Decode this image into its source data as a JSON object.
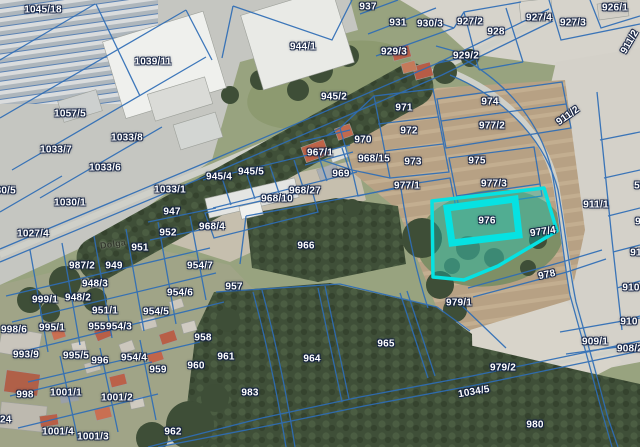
{
  "map": {
    "type": "cadastral-parcel-viewer",
    "colors": {
      "parcel_line": "#2e6db6",
      "highlight": "#06e2e2",
      "label_text": "#ffffff",
      "label_halo": "#122042"
    },
    "selected_parcel": {
      "id": "976",
      "adjacent_overlay": "977/4"
    },
    "labels": [
      {
        "t": "1045/18",
        "x": 43,
        "y": 10
      },
      {
        "t": "1039/11",
        "x": 153,
        "y": 62
      },
      {
        "t": "1057/5",
        "x": 70,
        "y": 114
      },
      {
        "t": "1033/8",
        "x": 127,
        "y": 138
      },
      {
        "t": "1033/7",
        "x": 56,
        "y": 150
      },
      {
        "t": "1033/6",
        "x": 105,
        "y": 168
      },
      {
        "t": "1030/5",
        "x": 0,
        "y": 191
      },
      {
        "t": "1030/1",
        "x": 70,
        "y": 203
      },
      {
        "t": "1033/1",
        "x": 170,
        "y": 190
      },
      {
        "t": "1027/4",
        "x": 33,
        "y": 234
      },
      {
        "t": "944/1",
        "x": 303,
        "y": 47
      },
      {
        "t": "937",
        "x": 368,
        "y": 7
      },
      {
        "t": "931",
        "x": 398,
        "y": 23
      },
      {
        "t": "930/3",
        "x": 430,
        "y": 24
      },
      {
        "t": "927/2",
        "x": 470,
        "y": 22
      },
      {
        "t": "928",
        "x": 496,
        "y": 32
      },
      {
        "t": "929/3",
        "x": 394,
        "y": 52
      },
      {
        "t": "929/2",
        "x": 466,
        "y": 56
      },
      {
        "t": "926/1",
        "x": 615,
        "y": 8
      },
      {
        "t": "927/4",
        "x": 539,
        "y": 18
      },
      {
        "t": "927/3",
        "x": 573,
        "y": 23
      },
      {
        "t": "945/2",
        "x": 334,
        "y": 97
      },
      {
        "t": "971",
        "x": 404,
        "y": 108
      },
      {
        "t": "974",
        "x": 490,
        "y": 102
      },
      {
        "t": "972",
        "x": 409,
        "y": 131
      },
      {
        "t": "977/2",
        "x": 492,
        "y": 126
      },
      {
        "t": "970",
        "x": 363,
        "y": 140
      },
      {
        "t": "968/15",
        "x": 374,
        "y": 159
      },
      {
        "t": "973",
        "x": 413,
        "y": 162
      },
      {
        "t": "975",
        "x": 477,
        "y": 161
      },
      {
        "t": "969",
        "x": 341,
        "y": 174
      },
      {
        "t": "977/3",
        "x": 494,
        "y": 184
      },
      {
        "t": "977/1",
        "x": 407,
        "y": 186
      },
      {
        "t": "967/1",
        "x": 320,
        "y": 153
      },
      {
        "t": "945/4",
        "x": 219,
        "y": 177
      },
      {
        "t": "945/5",
        "x": 251,
        "y": 172
      },
      {
        "t": "968/27",
        "x": 305,
        "y": 191
      },
      {
        "t": "968/10",
        "x": 277,
        "y": 199
      },
      {
        "t": "968/4",
        "x": 212,
        "y": 227
      },
      {
        "t": "947",
        "x": 172,
        "y": 212
      },
      {
        "t": "952",
        "x": 168,
        "y": 233
      },
      {
        "t": "951",
        "x": 140,
        "y": 248
      },
      {
        "t": "Dolga",
        "x": 113,
        "y": 244,
        "rot": -8,
        "dark": true
      },
      {
        "t": "966",
        "x": 306,
        "y": 246
      },
      {
        "t": "911/2",
        "x": 568,
        "y": 116,
        "rot": -35
      },
      {
        "t": "911/2",
        "x": 630,
        "y": 42,
        "rot": -60
      },
      {
        "t": "911/1",
        "x": 596,
        "y": 205
      },
      {
        "t": "976",
        "x": 487,
        "y": 221
      },
      {
        "t": "977/4",
        "x": 543,
        "y": 232,
        "rot": -8
      },
      {
        "t": "978",
        "x": 547,
        "y": 275,
        "rot": -12
      },
      {
        "t": "987/2",
        "x": 82,
        "y": 266
      },
      {
        "t": "949",
        "x": 114,
        "y": 266
      },
      {
        "t": "954/7",
        "x": 200,
        "y": 266
      },
      {
        "t": "948/3",
        "x": 95,
        "y": 284
      },
      {
        "t": "957",
        "x": 234,
        "y": 287
      },
      {
        "t": "954/6",
        "x": 180,
        "y": 293
      },
      {
        "t": "954/5",
        "x": 156,
        "y": 312
      },
      {
        "t": "999/1",
        "x": 45,
        "y": 300
      },
      {
        "t": "948/2",
        "x": 78,
        "y": 298
      },
      {
        "t": "951/1",
        "x": 105,
        "y": 311
      },
      {
        "t": "998/6",
        "x": 14,
        "y": 330
      },
      {
        "t": "995/1",
        "x": 52,
        "y": 328
      },
      {
        "t": "955",
        "x": 97,
        "y": 327
      },
      {
        "t": "954/3",
        "x": 119,
        "y": 327
      },
      {
        "t": "958",
        "x": 203,
        "y": 338
      },
      {
        "t": "993/9",
        "x": 26,
        "y": 355
      },
      {
        "t": "995/5",
        "x": 76,
        "y": 356
      },
      {
        "t": "996",
        "x": 100,
        "y": 361
      },
      {
        "t": "954/4",
        "x": 134,
        "y": 358
      },
      {
        "t": "959",
        "x": 158,
        "y": 370
      },
      {
        "t": "960",
        "x": 196,
        "y": 366
      },
      {
        "t": "998",
        "x": 25,
        "y": 395
      },
      {
        "t": "1001/1",
        "x": 66,
        "y": 393
      },
      {
        "t": "1001/2",
        "x": 117,
        "y": 398
      },
      {
        "t": "1024",
        "x": 0,
        "y": 420
      },
      {
        "t": "1001/4",
        "x": 58,
        "y": 432
      },
      {
        "t": "1001/3",
        "x": 93,
        "y": 437
      },
      {
        "t": "962",
        "x": 173,
        "y": 432
      },
      {
        "t": "961",
        "x": 226,
        "y": 357
      },
      {
        "t": "983",
        "x": 250,
        "y": 393
      },
      {
        "t": "964",
        "x": 312,
        "y": 359
      },
      {
        "t": "965",
        "x": 386,
        "y": 344
      },
      {
        "t": "5",
        "x": 637,
        "y": 186
      },
      {
        "t": "9",
        "x": 638,
        "y": 222
      },
      {
        "t": "91",
        "x": 636,
        "y": 253
      },
      {
        "t": "910",
        "x": 631,
        "y": 288
      },
      {
        "t": "910",
        "x": 629,
        "y": 322
      },
      {
        "t": "909/1",
        "x": 595,
        "y": 342
      },
      {
        "t": "908/2",
        "x": 630,
        "y": 349
      },
      {
        "t": "979/1",
        "x": 459,
        "y": 303
      },
      {
        "t": "979/2",
        "x": 503,
        "y": 368
      },
      {
        "t": "1034/5",
        "x": 474,
        "y": 392,
        "rot": -10
      },
      {
        "t": "980",
        "x": 535,
        "y": 425
      }
    ]
  }
}
